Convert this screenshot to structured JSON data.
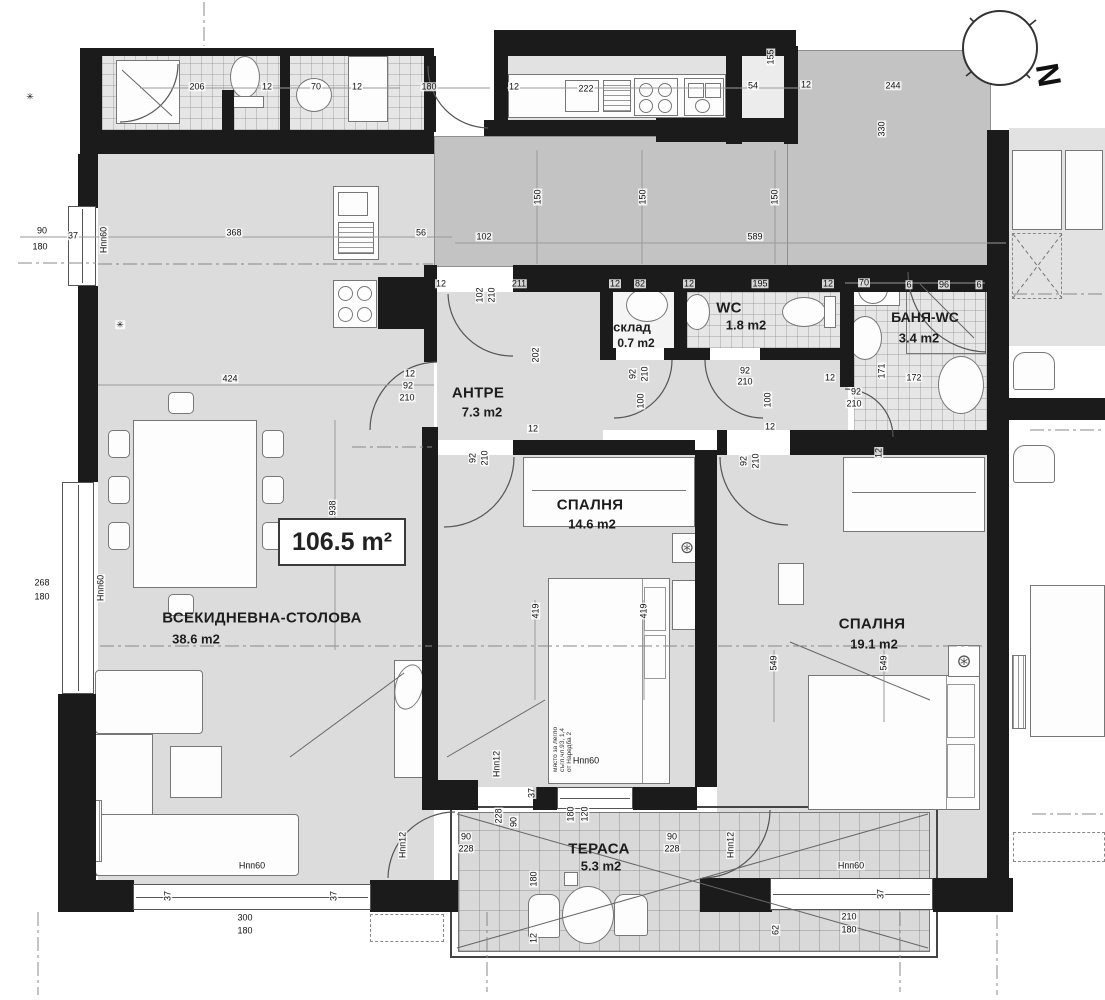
{
  "meta": {
    "total_area_label": "106.5 m²",
    "north_letter": "N"
  },
  "rooms": {
    "living": {
      "name": "ВСЕКИДНЕВНА-СТОЛОВА",
      "area": "38.6 m2"
    },
    "bedroom1": {
      "name": "СПАЛНЯ",
      "area": "14.6 m2"
    },
    "bedroom2": {
      "name": "СПАЛНЯ",
      "area": "19.1 m2"
    },
    "antre": {
      "name": "АНТРЕ",
      "area": "7.3 m2"
    },
    "wc": {
      "name": "WC",
      "area": "1.8 m2"
    },
    "banya": {
      "name": "БАНЯ-WC",
      "area": "3.4 m2"
    },
    "sklad": {
      "name": "склад",
      "area": "0.7 m2"
    },
    "terrace": {
      "name": "ТЕРАСА",
      "area": "5.3 m2"
    }
  },
  "bed_note": {
    "lines": [
      "място за легло",
      "съгл.чл.93, 1,4",
      "от Наредба 2"
    ]
  },
  "colors": {
    "wall": "#1b1b1b",
    "room_fill": "#dcdcdc",
    "corridor_fill": "#c3c3c3",
    "terrace_fill": "#d9d9d9",
    "line": "#555555"
  },
  "dimensions": [
    {
      "t": "206",
      "x": 197,
      "y": 87
    },
    {
      "t": "12",
      "x": 267,
      "y": 87
    },
    {
      "t": "70",
      "x": 316,
      "y": 87
    },
    {
      "t": "12",
      "x": 357,
      "y": 87
    },
    {
      "t": "180",
      "x": 429,
      "y": 87
    },
    {
      "t": "12",
      "x": 514,
      "y": 87
    },
    {
      "t": "222",
      "x": 586,
      "y": 89
    },
    {
      "t": "54",
      "x": 753,
      "y": 86
    },
    {
      "t": "12",
      "x": 806,
      "y": 85
    },
    {
      "t": "155",
      "x": 771,
      "y": 57,
      "r": 1
    },
    {
      "t": "244",
      "x": 893,
      "y": 86
    },
    {
      "t": "330",
      "x": 882,
      "y": 129,
      "r": 1
    },
    {
      "t": "90",
      "x": 42,
      "y": 231
    },
    {
      "t": "37",
      "x": 73,
      "y": 236
    },
    {
      "t": "180",
      "x": 40,
      "y": 247
    },
    {
      "t": "368",
      "x": 234,
      "y": 233
    },
    {
      "t": "56",
      "x": 421,
      "y": 233
    },
    {
      "t": "102",
      "x": 484,
      "y": 237
    },
    {
      "t": "589",
      "x": 755,
      "y": 237
    },
    {
      "t": "150",
      "x": 538,
      "y": 197,
      "r": 1
    },
    {
      "t": "150",
      "x": 643,
      "y": 197,
      "r": 1
    },
    {
      "t": "150",
      "x": 775,
      "y": 197,
      "r": 1
    },
    {
      "t": "12",
      "x": 441,
      "y": 284
    },
    {
      "t": "211",
      "x": 519,
      "y": 284
    },
    {
      "t": "12",
      "x": 615,
      "y": 284
    },
    {
      "t": "82",
      "x": 640,
      "y": 284
    },
    {
      "t": "12",
      "x": 689,
      "y": 284
    },
    {
      "t": "195",
      "x": 760,
      "y": 284
    },
    {
      "t": "12",
      "x": 828,
      "y": 284
    },
    {
      "t": "70",
      "x": 864,
      "y": 283
    },
    {
      "t": "6",
      "x": 909,
      "y": 285
    },
    {
      "t": "96",
      "x": 944,
      "y": 285
    },
    {
      "t": "6",
      "x": 979,
      "y": 285
    },
    {
      "t": "102",
      "x": 480,
      "y": 295,
      "r": 1
    },
    {
      "t": "210",
      "x": 492,
      "y": 295,
      "r": 1
    },
    {
      "t": "202",
      "x": 536,
      "y": 355,
      "r": 1
    },
    {
      "t": "92",
      "x": 633,
      "y": 374,
      "r": 1
    },
    {
      "t": "210",
      "x": 645,
      "y": 374,
      "r": 1
    },
    {
      "t": "100",
      "x": 641,
      "y": 401,
      "r": 1
    },
    {
      "t": "92",
      "x": 745,
      "y": 371
    },
    {
      "t": "210",
      "x": 745,
      "y": 382
    },
    {
      "t": "100",
      "x": 768,
      "y": 400,
      "r": 1
    },
    {
      "t": "12",
      "x": 770,
      "y": 427
    },
    {
      "t": "12",
      "x": 830,
      "y": 378
    },
    {
      "t": "92",
      "x": 856,
      "y": 392
    },
    {
      "t": "210",
      "x": 854,
      "y": 404
    },
    {
      "t": "171",
      "x": 882,
      "y": 371,
      "r": 1
    },
    {
      "t": "172",
      "x": 914,
      "y": 378
    },
    {
      "t": "12",
      "x": 410,
      "y": 374
    },
    {
      "t": "92",
      "x": 408,
      "y": 386
    },
    {
      "t": "210",
      "x": 407,
      "y": 398
    },
    {
      "t": "92",
      "x": 473,
      "y": 458,
      "r": 1
    },
    {
      "t": "210",
      "x": 485,
      "y": 458,
      "r": 1
    },
    {
      "t": "12",
      "x": 533,
      "y": 429
    },
    {
      "t": "92",
      "x": 744,
      "y": 461,
      "r": 1
    },
    {
      "t": "210",
      "x": 756,
      "y": 461,
      "r": 1
    },
    {
      "t": "12",
      "x": 879,
      "y": 453,
      "r": 1
    },
    {
      "t": "424",
      "x": 230,
      "y": 379
    },
    {
      "t": "938",
      "x": 333,
      "y": 508,
      "r": 1
    },
    {
      "t": "268",
      "x": 42,
      "y": 583
    },
    {
      "t": "180",
      "x": 42,
      "y": 597
    },
    {
      "t": "419",
      "x": 536,
      "y": 611,
      "r": 1
    },
    {
      "t": "419",
      "x": 644,
      "y": 611,
      "r": 1
    },
    {
      "t": "549",
      "x": 774,
      "y": 663,
      "r": 1
    },
    {
      "t": "549",
      "x": 884,
      "y": 663,
      "r": 1
    },
    {
      "t": "37",
      "x": 168,
      "y": 896,
      "r": 1
    },
    {
      "t": "300",
      "x": 245,
      "y": 918
    },
    {
      "t": "180",
      "x": 245,
      "y": 931
    },
    {
      "t": "37",
      "x": 334,
      "y": 896,
      "r": 1
    },
    {
      "t": "37",
      "x": 881,
      "y": 894,
      "r": 1
    },
    {
      "t": "210",
      "x": 849,
      "y": 917
    },
    {
      "t": "180",
      "x": 849,
      "y": 930
    },
    {
      "t": "62",
      "x": 776,
      "y": 930,
      "r": 1
    },
    {
      "t": "90",
      "x": 466,
      "y": 837
    },
    {
      "t": "228",
      "x": 466,
      "y": 849
    },
    {
      "t": "90",
      "x": 672,
      "y": 837
    },
    {
      "t": "228",
      "x": 672,
      "y": 849
    },
    {
      "t": "228",
      "x": 499,
      "y": 816,
      "r": 1
    },
    {
      "t": "90",
      "x": 514,
      "y": 822,
      "r": 1
    },
    {
      "t": "120",
      "x": 585,
      "y": 814,
      "r": 1
    },
    {
      "t": "180",
      "x": 571,
      "y": 814,
      "r": 1
    },
    {
      "t": "180",
      "x": 534,
      "y": 879,
      "r": 1
    },
    {
      "t": "37",
      "x": 532,
      "y": 793,
      "r": 1
    },
    {
      "t": "12",
      "x": 534,
      "y": 938,
      "r": 1
    },
    {
      "t": "Нпп60",
      "x": 104,
      "y": 240,
      "r": 1,
      "n": "floor-height-note"
    },
    {
      "t": "Нпп60",
      "x": 101,
      "y": 588,
      "r": 1,
      "n": "floor-height-note"
    },
    {
      "t": "Нпп60",
      "x": 252,
      "y": 866,
      "n": "floor-height-note"
    },
    {
      "t": "Нпп60",
      "x": 586,
      "y": 761,
      "n": "floor-height-note"
    },
    {
      "t": "Нпп60",
      "x": 851,
      "y": 866,
      "n": "floor-height-note"
    },
    {
      "t": "Нпп12",
      "x": 497,
      "y": 764,
      "r": 1,
      "n": "floor-height-note"
    },
    {
      "t": "Нпп12",
      "x": 403,
      "y": 845,
      "r": 1,
      "n": "floor-height-note"
    },
    {
      "t": "Нпп12",
      "x": 731,
      "y": 845,
      "r": 1,
      "n": "floor-height-note"
    },
    {
      "t": "✳",
      "x": 120,
      "y": 325,
      "n": "vent-symbol"
    },
    {
      "t": "✳",
      "x": 30,
      "y": 97,
      "n": "vent-symbol"
    }
  ]
}
